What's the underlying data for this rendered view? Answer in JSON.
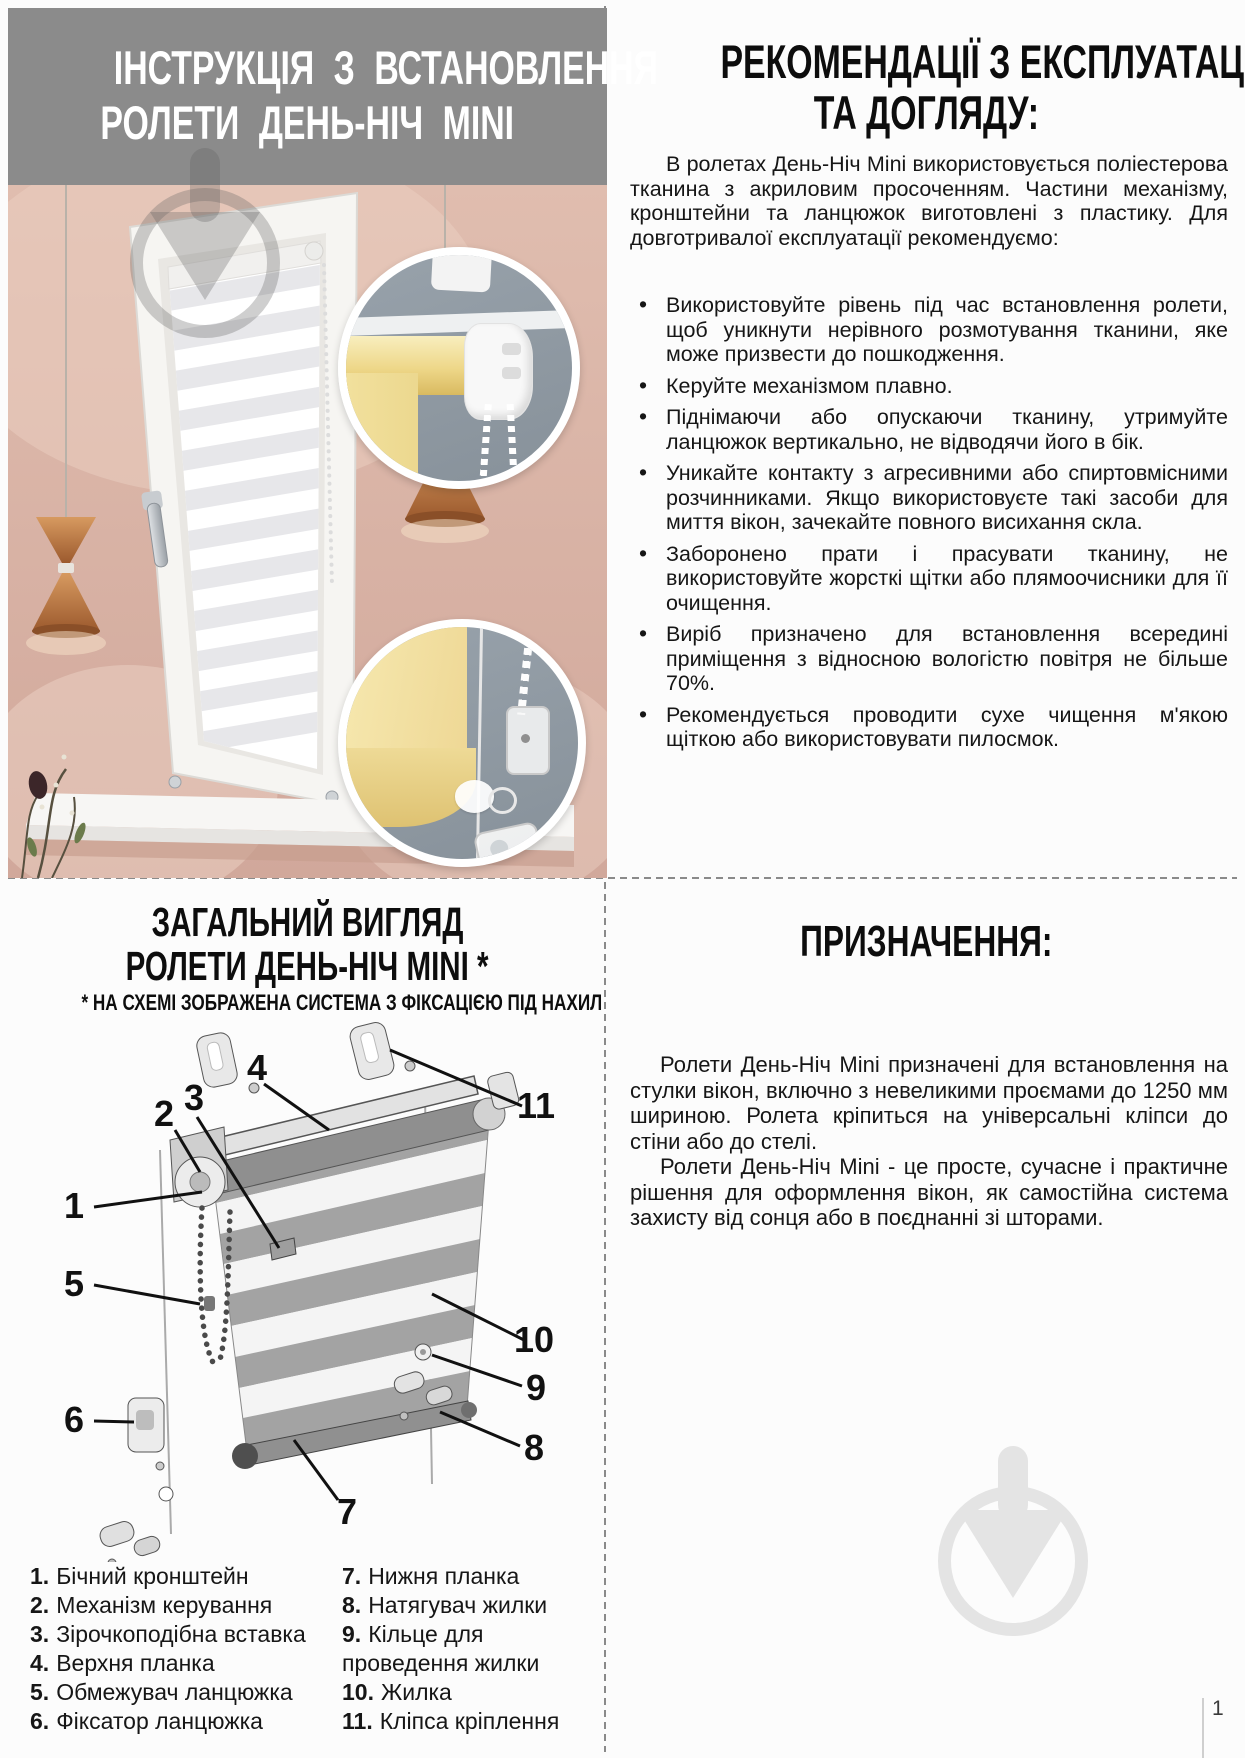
{
  "page": {
    "number": "1"
  },
  "left_top": {
    "title_line1": "ІНСТРУКЦІЯ З ВСТАНОВЛЕННЯ",
    "title_line2": "РОЛЕТИ ДЕНЬ-НІЧ MINI"
  },
  "recommendations": {
    "title_line1": "РЕКОМЕНДАЦІЇ З ЕКСПЛУАТАЦІЇ",
    "title_line2": "ТА ДОГЛЯДУ:",
    "intro": "В ролетах День-Ніч Mini використовується поліестерова тканина з акриловим просоченням. Частини механізму, кронштейни та ланцюжок виготовлені з пластику. Для довготривалої експлуатації рекомендуємо:",
    "bullets": [
      "Використовуйте рівень під час встановлення ролети, щоб уникнути нерівного розмотування тканини, яке може призвести до пошкодження.",
      "Керуйте механізмом плавно.",
      "Піднімаючи або опускаючи тканину, утримуйте ланцюжок вертикально, не відводячи його в бік.",
      "Уникайте контакту з агресивними або спиртовмісними розчинниками. Якщо використовуєте такі засоби для миття вікон, зачекайте повного висихання скла.",
      "Заборонено прати і прасувати тканину, не використовуйте жорсткі щітки або плямоочисники для її очищення.",
      "Виріб призначено для встановлення всередині приміщення з відносною вологістю повітря не більше 70%.",
      "Рекомендується проводити сухе чищення м'якою щіткою або використовувати пилосмок."
    ]
  },
  "overview": {
    "title_line1": "ЗАГАЛЬНИЙ ВИГЛЯД",
    "title_line2": "РОЛЕТИ ДЕНЬ-НІЧ MINI *",
    "note": "* НА СХЕМІ ЗОБРАЖЕНА СИСТЕМА З ФІКСАЦІЄЮ ПІД НАХИЛ",
    "callouts": [
      "1",
      "2",
      "3",
      "4",
      "5",
      "6",
      "7",
      "8",
      "9",
      "10",
      "11"
    ],
    "parts_col1": [
      {
        "num": "1.",
        "label": "Бічний кронштейн"
      },
      {
        "num": "2.",
        "label": "Механізм керування"
      },
      {
        "num": "3.",
        "label": "Зірочкоподібна вставка"
      },
      {
        "num": "4.",
        "label": "Верхня планка"
      },
      {
        "num": "5.",
        "label": "Обмежувач ланцюжка"
      },
      {
        "num": "6.",
        "label": "Фіксатор ланцюжка"
      }
    ],
    "parts_col2": [
      {
        "num": "7.",
        "label": "Нижня планка"
      },
      {
        "num": "8.",
        "label": "Натягувач жилки"
      },
      {
        "num": "9.",
        "label": "Кільце для проведення жилки"
      },
      {
        "num": "10.",
        "label": "Жилка"
      },
      {
        "num": "11.",
        "label": "Кліпса кріплення"
      }
    ]
  },
  "purpose": {
    "title": "ПРИЗНАЧЕННЯ:",
    "paragraphs": [
      "Ролети День-Ніч Mini призначені для встановлення на стулки вікон, включно з невеликими проємами до 1250 мм шириною. Ролета кріпиться на універсальні кліпси до стіни або до стелі.",
      "Ролети День-Ніч Mini - це просте, сучасне і практичне рішення для оформлення вікон, як самостійна система захисту від сонця або в поєднанні зі шторами."
    ]
  },
  "colors": {
    "header_gray": "#8b8b8b",
    "text_black": "#161616",
    "wall_pink": "#d8b3a5",
    "inset_blue_gray": "#8f99a2",
    "fabric_yellow": "#eed88c",
    "watermark_light": "#e4e4e4"
  }
}
